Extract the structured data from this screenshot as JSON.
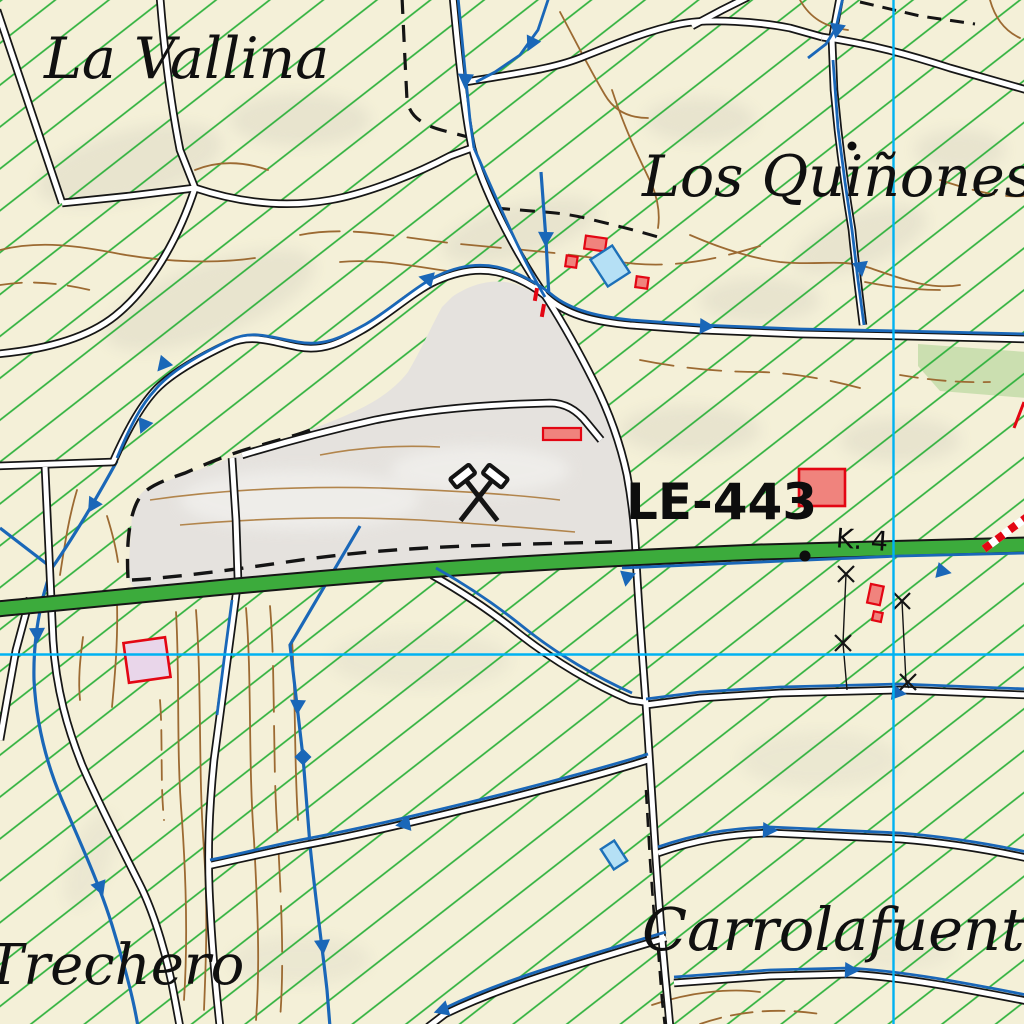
{
  "map": {
    "type": "topographic-map",
    "labels": {
      "la_vallina": "La Vallina",
      "los_quinones": "Los Quiñones",
      "trechero": "Trechero",
      "carrolafuente": "Carrolafuente",
      "road_ref": "LE-443",
      "km_marker": "K. 4"
    },
    "symbols": {
      "mine": "crossed-hammers"
    }
  },
  "colors": {
    "background": "#f4f0d8",
    "hatch_green": "#2eb13c",
    "grid_cyan": "#00b2f2",
    "road_green": "#3cab3c",
    "road_casing": "#161616",
    "road_fill": "#ffffff",
    "stream_blue": "#1a67b8",
    "contour_brown": "#9c6a32",
    "contour_light": "#b2854c",
    "quarry_gray": "#e5e2de",
    "forest_green": "#cbdfb0",
    "building_red_fill": "#f0837d",
    "building_red_stroke": "#e30613",
    "building_blue_fill": "#b5e0f5",
    "building_blue_stroke": "#1d70b8",
    "building_pink_fill": "#e9d6ea",
    "label_black": "#101010"
  }
}
